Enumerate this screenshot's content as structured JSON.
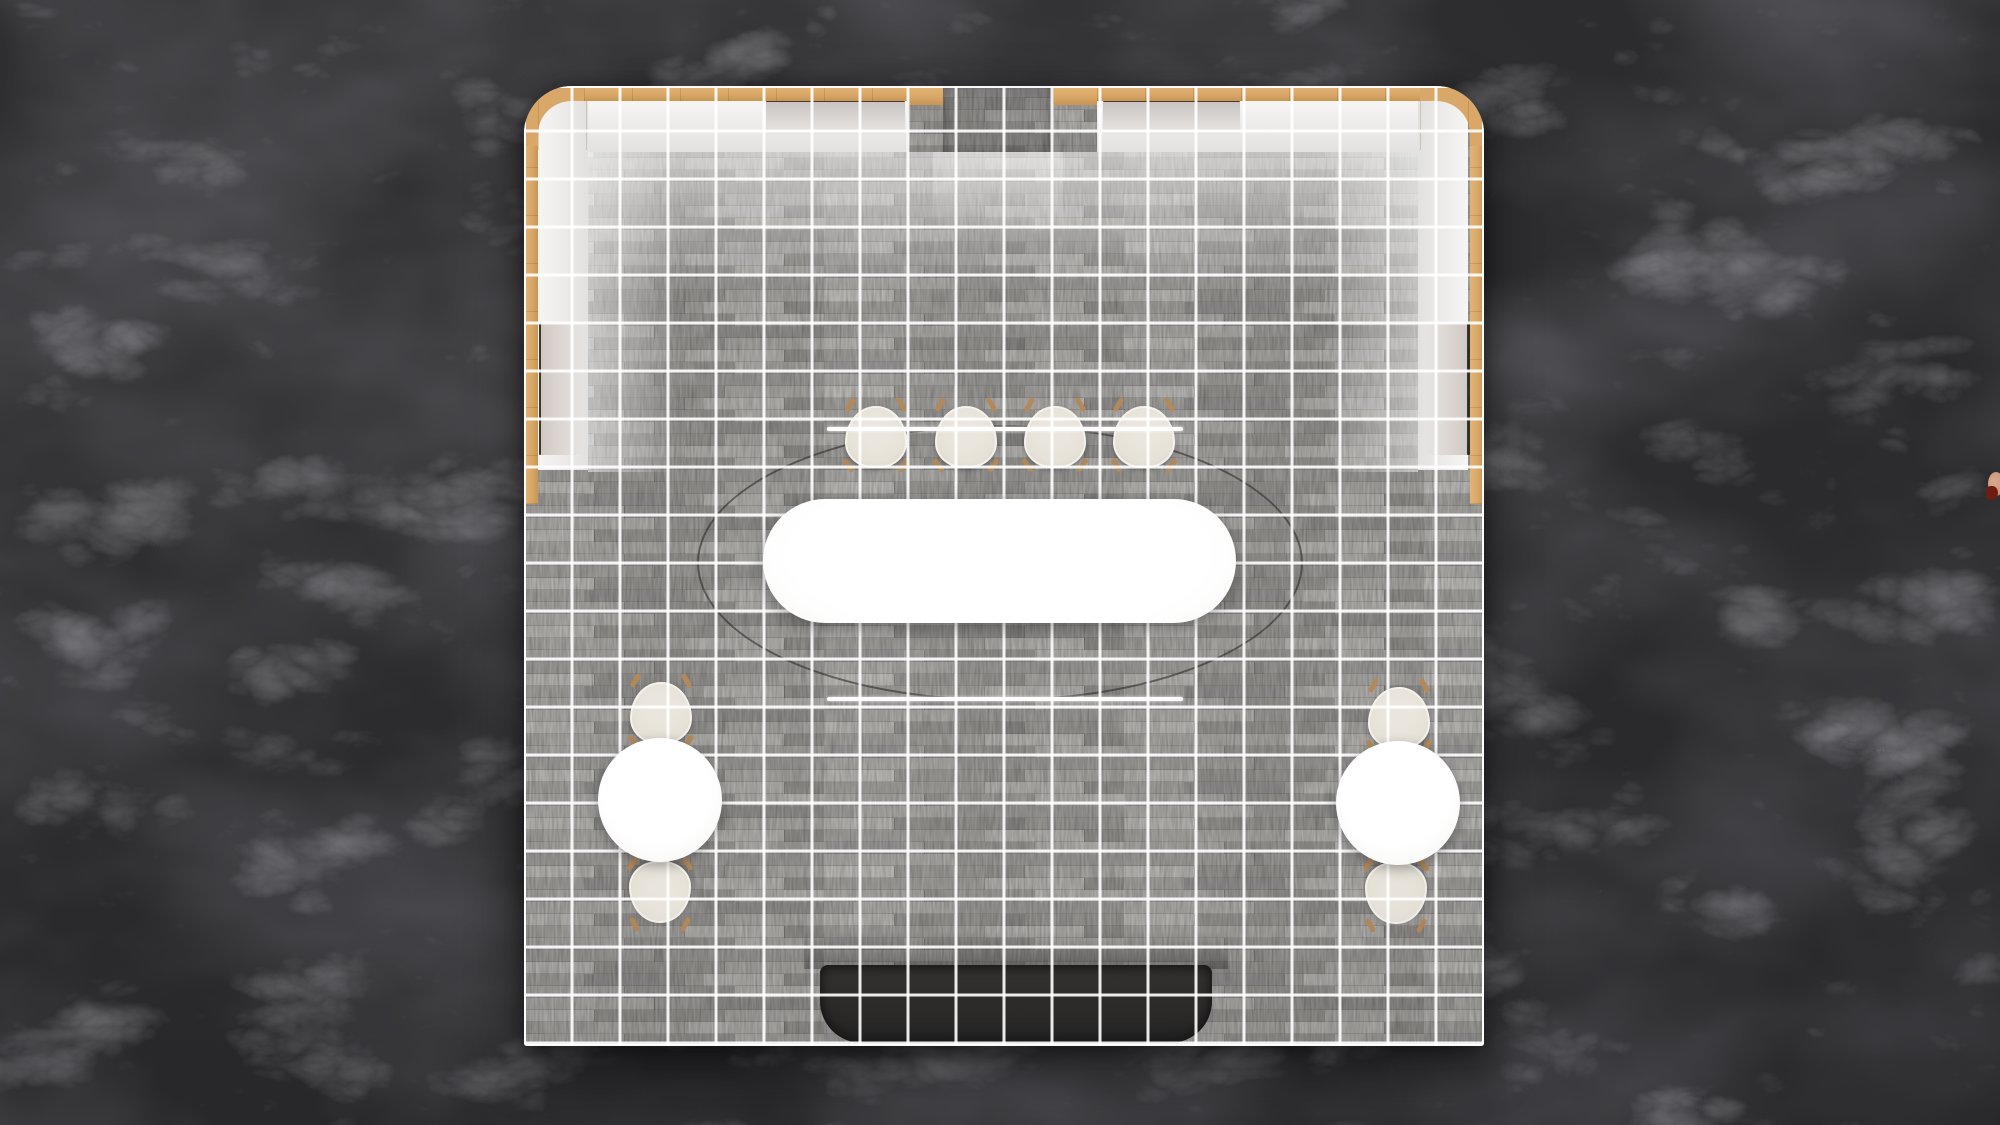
{
  "colors": {
    "marble_base": "#57575c",
    "marble_vein": "#c6c6cd",
    "floor_base": "#9e9c99",
    "grid_line": "rgba(255,255,255,0.90)",
    "wood": "#d9a868",
    "counter_white": "#f6f5f3",
    "counter_shade": "#e3e1df",
    "shelf_line": "#1f1a16",
    "bench": "#2d2c2b",
    "table_white": "#fdfdfc",
    "chair_cream": "#e7e2d8",
    "chair_rim": "#f5f2ec",
    "chair_leg": "#b3895a",
    "ring_frame": "rgba(45,42,40,0.60)",
    "ring_light": "#ffffff",
    "artifact_skin": "#c39078",
    "artifact_red": "#6f1d12"
  },
  "booth": {
    "x": 524,
    "y": 86,
    "size": 960,
    "grid_spacing": 48,
    "wall_wood_thickness": 14
  },
  "furniture": {
    "entrance_corridor": {
      "x": 419,
      "y": 0,
      "w": 110,
      "h": 66
    },
    "ring": {
      "cx": 476,
      "cy": 477,
      "rx": 303,
      "ry": 138
    },
    "ring_lines": [
      {
        "x": 303,
        "y": 341,
        "w": 356
      },
      {
        "x": 303,
        "y": 611,
        "w": 356
      }
    ],
    "center_table": {
      "x": 239,
      "y": 413,
      "w": 473,
      "h": 124
    },
    "round_tables": [
      {
        "cx": 136,
        "cy": 714,
        "r": 62
      },
      {
        "cx": 874,
        "cy": 717,
        "r": 62
      }
    ],
    "chairs": [
      {
        "cx": 352,
        "cy": 351,
        "facing": "down"
      },
      {
        "cx": 442,
        "cy": 351,
        "facing": "down"
      },
      {
        "cx": 531,
        "cy": 351,
        "facing": "down"
      },
      {
        "cx": 620,
        "cy": 351,
        "facing": "down"
      },
      {
        "cx": 137,
        "cy": 627,
        "facing": "down"
      },
      {
        "cx": 136,
        "cy": 806,
        "facing": "up"
      },
      {
        "cx": 875,
        "cy": 632,
        "facing": "down"
      },
      {
        "cx": 872,
        "cy": 807,
        "facing": "up"
      }
    ],
    "bench": {
      "x": 296,
      "y": 879,
      "w": 392,
      "h": 78
    }
  },
  "edge_artifact": {
    "x": 1988,
    "y": 472
  }
}
